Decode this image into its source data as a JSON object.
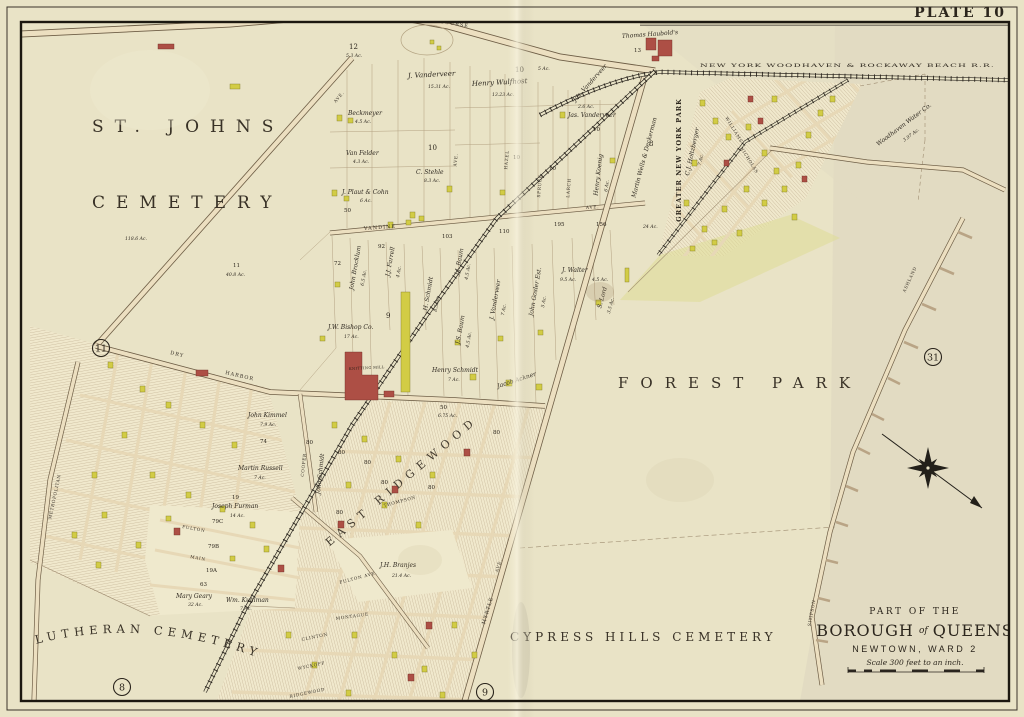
{
  "plate": "PLATE 10",
  "colors": {
    "paper": "#e9e3c6",
    "frame_ink": "#221d15",
    "road_fill": "#ecdfc0",
    "road_casing": "#6e5e46",
    "building_yellow": "#d2cc45",
    "building_red": "#ad4f45",
    "hatch": "#a38f6e"
  },
  "circled": {
    "top": "18",
    "west": "11",
    "east": "31",
    "south_west": "8",
    "south": "9"
  },
  "regions": {
    "st_johns": "ST. JOHNS",
    "cemetery": "CEMETERY",
    "forest_park": "FOREST PARK",
    "lutheran_cemetery": "LUTHERAN CEMETERY",
    "cypress_hills": "CYPRESS HILLS CEMETERY",
    "greater_ny_park": "GREATER NEW YORK PARK",
    "east_ridgewood": "EAST RIDGEWOOD"
  },
  "title_block": {
    "part_of": "PART OF THE",
    "borough": "BOROUGH",
    "of": "of",
    "queens": "QUEENS",
    "newtown": "NEWTOWN, WARD 2",
    "scale": "Scale 300 feet to an inch."
  },
  "railroads": {
    "woodhaven_rockaway": "NEW YORK WOODHAVEN & ROCKAWAY BEACH R.R."
  },
  "streets": {
    "trotting": "TROTTING",
    "course": "COURSE",
    "vandine": "VANDINE",
    "ave": "AVE.",
    "myrtle": "MYRTLE",
    "dry": "DRY",
    "harbor": "HARBOR",
    "metropolitan": "METROPOLITAN",
    "cooper": "COOPER",
    "montague": "MONTAGUE",
    "thompson": "THOMPSON",
    "fulton": "FULTON",
    "main": "MAIN",
    "clinton": "CLINTON",
    "wyckoff": "WYCKOFF",
    "ridgewood": "RIDGEWOOD",
    "fulton_ave": "FULTON AVE.",
    "ashland": "ASHLAND",
    "simpson": "SIMPSON",
    "williams": "WILLIAMS",
    "nicholas": "NICHOLAS",
    "hazel": "HAZEL",
    "spruce": "SPRUCE",
    "larch": "LARCH"
  },
  "parcels": {
    "j_vanderveer": {
      "name": "J. Vanderveer",
      "acres": "15.31 Ac."
    },
    "henry_wulfhost": {
      "name": "Henry Wulfhost",
      "acres": "13.23 Ac."
    },
    "beckmeyer": {
      "name": "Beckmeyer",
      "acres": "4.5 Ac."
    },
    "van_felder": {
      "name": "Van Felder",
      "acres": "4.3 Ac."
    },
    "c_stehle": {
      "name": "C. Stehle",
      "acres": "8.3 Ac."
    },
    "plaut_cohn": {
      "name": "J. Plaut & Cohn",
      "acres": "6 Ac."
    },
    "jos_vanderveer": {
      "name": "Jos. Vanderveer"
    },
    "jas_vanderveer": {
      "name": "Jas. Vanderveer",
      "acres": "2.6 Ac."
    },
    "henry_koenig": {
      "name": "Henry Koenig",
      "acres": "6 Ac."
    },
    "wells_deckerman": {
      "name": "Martin Wells & Deckerman"
    },
    "holtzberger": {
      "name": "C.J. Holtzberger",
      "acres": "7 Ac."
    },
    "thomas_haubold": {
      "name": "Thomas Haubold's"
    },
    "woodhaven_water": {
      "name": "Woodhaven Water Co.",
      "acres": "3.97 Ac."
    },
    "john_brocklum": {
      "name": "John Brocklum",
      "acres": "6.5 Ac."
    },
    "jj_farrell": {
      "name": "J.J. Farrell",
      "acres": "4 Ac."
    },
    "h_schmidt": {
      "name": "H. Schmidt",
      "acres": "8.5 Ac."
    },
    "jj_baum": {
      "name": "J.J. Baum",
      "acres": "4.5 Ac."
    },
    "js_baum": {
      "name": "J.S. Baum",
      "acres": "4.5 Ac."
    },
    "j_vanderveer2": {
      "name": "J. Vanderveer",
      "acres": "7 Ac."
    },
    "john_gosler": {
      "name": "John Gosler Est.",
      "acres": "5 Ac."
    },
    "j_walter": {
      "name": "J. Walter",
      "acres": "9.5 Ac.",
      "acres2": "4.5 Ac."
    },
    "s_lord": {
      "name": "S. Lord",
      "acres": "3.5 Ac."
    },
    "jw_bishop": {
      "name": "J.W. Bishop Co.",
      "acres": "17 Ac."
    },
    "henry_schmidt": {
      "name": "Henry Schmidt",
      "acres": "7 Ac."
    },
    "jacob_ackner": {
      "name": "Jacob Ackner"
    },
    "john_kimmel": {
      "name": "John Kimmel",
      "acres": "7.9 Ac."
    },
    "martin_russell": {
      "name": "Martin Russell",
      "acres": "7 Ac."
    },
    "joseph_furman": {
      "name": "Joseph Furman",
      "acres": "14 Ac."
    },
    "jh_branjes": {
      "name": "J.H. Branjes",
      "acres": "21.4 Ac."
    },
    "mary_geary": {
      "name": "Mary Geary",
      "acres": "32 Ac."
    },
    "wm_kuhlman": {
      "name": "Wm. Kuhlman",
      "acres": "7 Ac."
    },
    "john_schmidt": {
      "name": "John Schmidt"
    }
  },
  "landmarks": {
    "knitting_mill": "KNITTING MILL"
  },
  "plot_numbers": {
    "n8": "8",
    "n9": "9",
    "n10": "10",
    "n11": "11",
    "n12": "12",
    "n13": "13",
    "n19": "19",
    "n19a": "19A",
    "n79b": "79B",
    "n79c": "79C",
    "n50": "50",
    "n63": "63",
    "n72": "72",
    "n74": "74",
    "n80": "80",
    "n92": "92",
    "n103": "103",
    "n110": "110",
    "n156": "156",
    "n195": "195"
  },
  "acre_notes": {
    "a53": "5.3 Ac.",
    "a5": "5 Ac.",
    "a24": "24 Ac.",
    "a675": "6.75 Ac.",
    "a1186": "118.6 Ac.",
    "a408": "40.8 Ac."
  }
}
